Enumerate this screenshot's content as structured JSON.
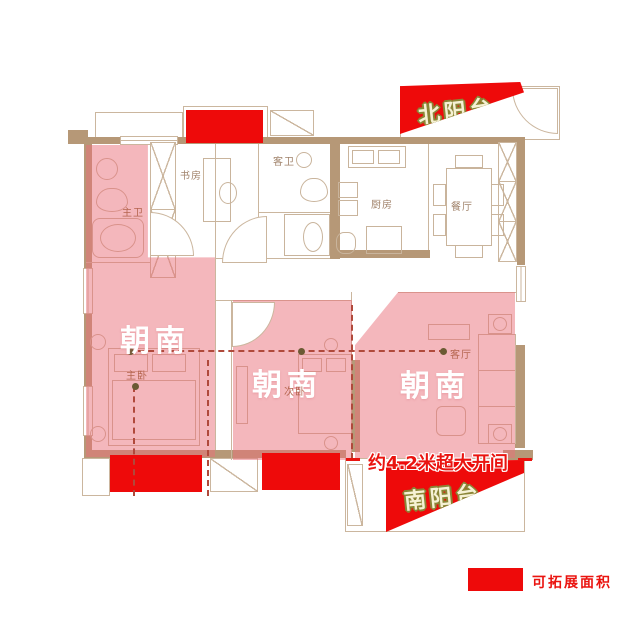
{
  "plan": {
    "balconies": {
      "north_label": "北阳台",
      "south_label": "南阳台"
    },
    "south_facing": [
      "朝南",
      "朝南",
      "朝南"
    ],
    "rooms": [
      {
        "id": "master-bath",
        "label": "主卫"
      },
      {
        "id": "study",
        "label": "书房"
      },
      {
        "id": "guest-bath",
        "label": "客卫"
      },
      {
        "id": "kitchen",
        "label": "厨房"
      },
      {
        "id": "dining-room",
        "label": "餐厅"
      },
      {
        "id": "master-bedroom",
        "label": "主卧"
      },
      {
        "id": "second-bedroom",
        "label": "次卧"
      },
      {
        "id": "living-room",
        "label": "客厅"
      }
    ],
    "callout_label": "约4.2米超大开间",
    "legend": {
      "label": "可拓展面积",
      "swatch_color": "#ee0a0a"
    },
    "colors": {
      "highlight_red": "#ee0a0a",
      "south_pink": "#f3b2b6",
      "wall_tan": "#b69877",
      "line": "#cbb69e",
      "callout_red": "#ea1410",
      "banner_text": "#f6f1d4",
      "banner_outline": "#8a8536"
    }
  }
}
